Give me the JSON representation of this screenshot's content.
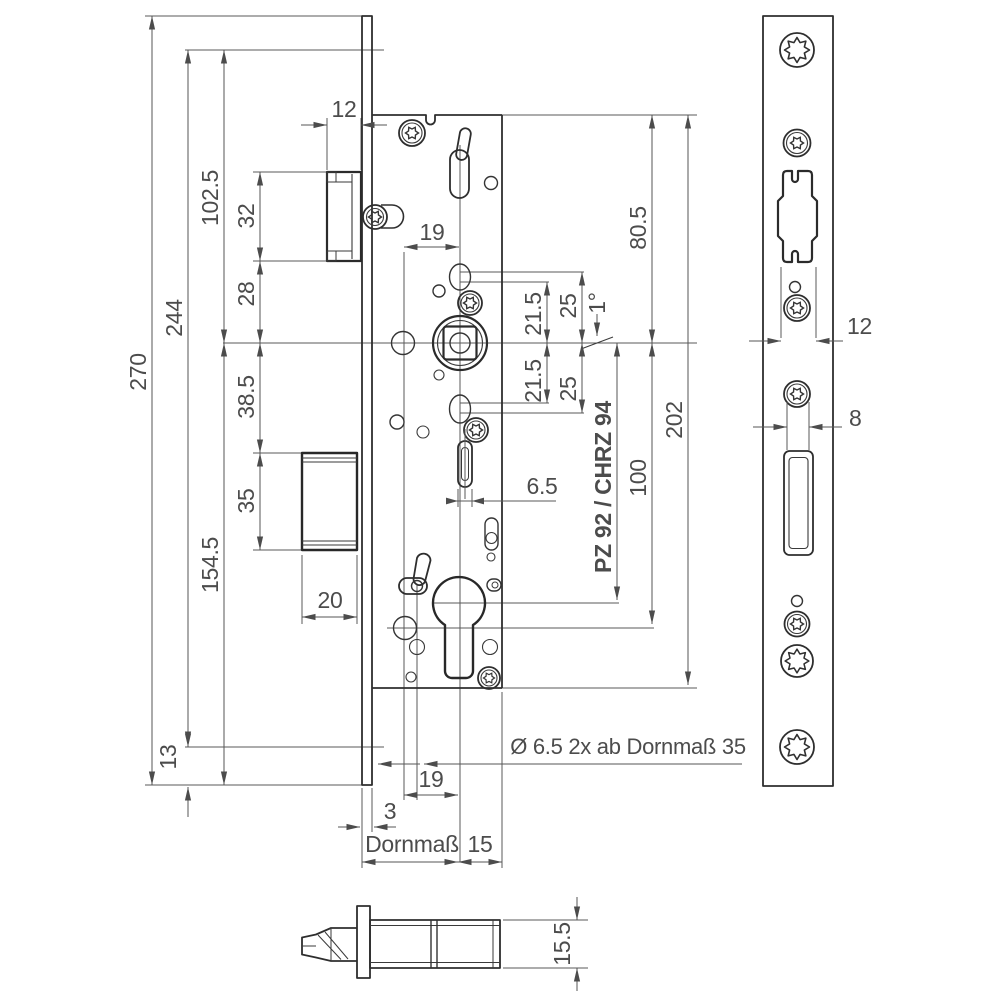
{
  "style": {
    "background": "#ffffff",
    "part_line_color": "#2e2e2e",
    "dimension_line_color": "#555555",
    "text_color": "#4c4c4c"
  },
  "front_view": {
    "dims": {
      "faceplate_length": "270",
      "screw_spacing": "244",
      "top_hole_to_axis": "102.5",
      "axis_to_bottom": "154.5",
      "latch_height": "32",
      "latch_to_axis": "28",
      "axis_to_deadbolt": "38.5",
      "deadbolt_height": "35",
      "bottom_offset": "13",
      "latch_protrusion": "12",
      "hole_to_axis_upper": "19",
      "deadbolt_width": "20",
      "hub_to_hole_upper_inner": "21.5",
      "hub_to_hole_upper_outer": "25",
      "hub_angle": "1°",
      "hub_to_hole_lower_inner": "21.5",
      "hub_to_hole_lower_outer": "25",
      "case_top_to_axis": "80.5",
      "case_length": "202",
      "axis_to_cylinder_hole": "100",
      "centres_variant": "PZ 92 / CHRZ 94",
      "slot_width": "6.5",
      "holes_note": "Ø 6.5  2x ab Dornmaß 35",
      "hole_to_axis_lower": "19",
      "faceplate_thickness": "3",
      "backset_label": "Dornmaß",
      "axis_to_case_back": "15"
    }
  },
  "faceplate_view": {
    "dims": {
      "channel_width": "12",
      "bolt_slot_width": "8"
    }
  },
  "section_view": {
    "dims": {
      "case_thickness": "15.5"
    }
  }
}
